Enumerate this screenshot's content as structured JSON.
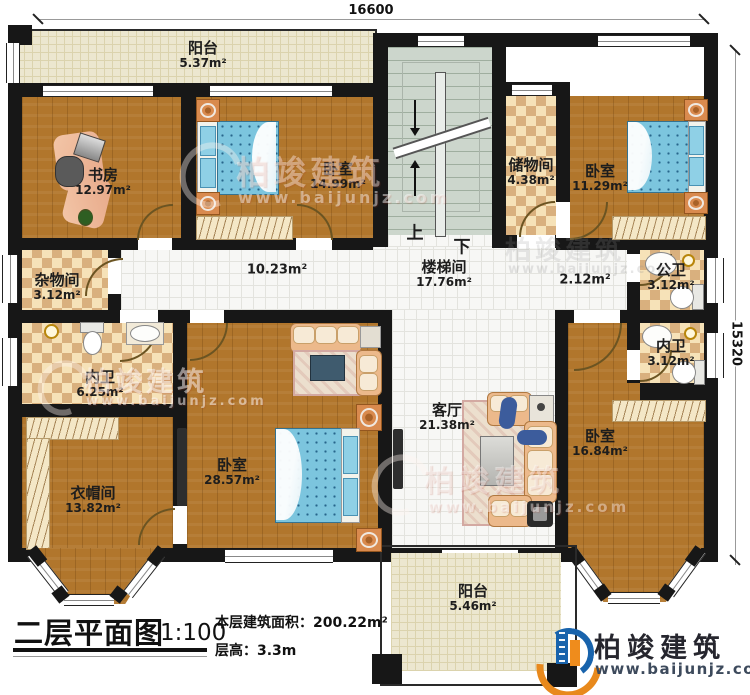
{
  "dimensions": {
    "top": "16600",
    "right": "15320"
  },
  "titleblock": {
    "title": "二层平面图",
    "scale": "1:100",
    "area_label": "本层建筑面积：",
    "area_value": "200.22m²",
    "height_label": "层高：",
    "height_value": "3.3m"
  },
  "brand": {
    "name": "柏竣建筑",
    "url": "www.baijunjz.com",
    "blue": "#1863ac",
    "orange": "#ef8c1c"
  },
  "watermark": {
    "name": "柏竣建筑",
    "url": "www.baijunjz.com"
  },
  "stairs": {
    "up": "上",
    "down": "下"
  },
  "rooms": {
    "balcony_top": {
      "name": "阳台",
      "area": "5.37m²"
    },
    "study": {
      "name": "书房",
      "area": "12.97m²"
    },
    "bedroom_top": {
      "name": "卧室",
      "area": "14.99m²"
    },
    "storage": {
      "name": "储物间",
      "area": "4.38m²"
    },
    "bedroom_ne": {
      "name": "卧室",
      "area": "11.29m²"
    },
    "stairwell": {
      "name": "楼梯间",
      "area": "17.76m²"
    },
    "corridor": {
      "area": "10.23m²"
    },
    "hall": {
      "area": "2.12m²"
    },
    "sundry": {
      "name": "杂物间",
      "area": "3.12m²"
    },
    "public_bath": {
      "name": "公卫",
      "area": "3.12m²"
    },
    "inner_bath_right": {
      "name": "内卫",
      "area": "3.12m²"
    },
    "inner_bath_left": {
      "name": "内卫",
      "area": "6.25m²"
    },
    "cloakroom": {
      "name": "衣帽间",
      "area": "13.82m²"
    },
    "bedroom_master": {
      "name": "卧室",
      "area": "28.57m²"
    },
    "living": {
      "name": "客厅",
      "area": "21.38m²"
    },
    "bedroom_se": {
      "name": "卧室",
      "area": "16.84m²"
    },
    "balcony_bottom": {
      "name": "阳台",
      "area": "5.46m²"
    }
  }
}
